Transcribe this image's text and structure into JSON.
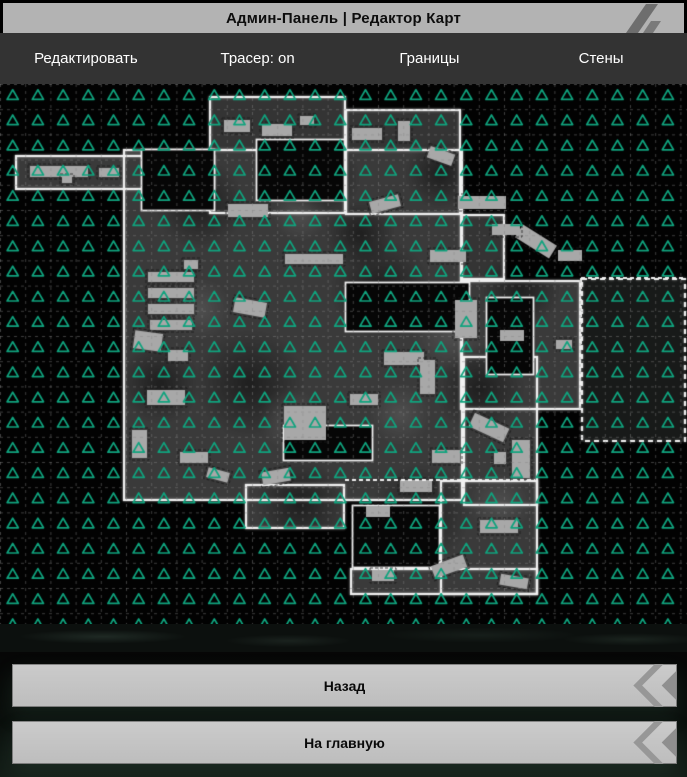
{
  "title_bar": {
    "title": "Админ-Панель | Редактор Карт"
  },
  "toolbar": {
    "items": [
      {
        "label": "Редактировать"
      },
      {
        "label": "Трасер: on"
      },
      {
        "label": "Границы"
      },
      {
        "label": "Стены"
      }
    ]
  },
  "footer": {
    "back_label": "Назад",
    "home_label": "На главную"
  },
  "map": {
    "width": 687,
    "height": 540,
    "colors": {
      "bg": "#020202",
      "floor": "#3a3a3a",
      "floor_dark": "#343434",
      "hole": "#060606",
      "wall": "#efefef",
      "prop": "#a8a8a8",
      "dim": "#181a19"
    },
    "grid": {
      "spacing": 25.2,
      "dash": [
        3,
        4
      ],
      "color": "rgba(135,135,135,0.45)"
    },
    "markers": {
      "cols": 27,
      "rows": 22,
      "start_x": 12.7,
      "start_y": 11,
      "spacing": 25.2,
      "color": "#10a37e",
      "half_width": 5.6,
      "up": 5.2,
      "down": 4.4,
      "line_width": 1.7
    },
    "rooms": [
      {
        "x": 15,
        "y": 71,
        "w": 200,
        "h": 35
      },
      {
        "x": 209,
        "y": 12,
        "w": 137,
        "h": 118,
        "fill": "#343434"
      },
      {
        "x": 345,
        "y": 25,
        "w": 116,
        "h": 106,
        "fill": "#343434"
      },
      {
        "x": 123,
        "y": 65,
        "w": 340,
        "h": 352
      },
      {
        "x": 460,
        "y": 130,
        "w": 45,
        "h": 66,
        "fill": "#343434"
      },
      {
        "x": 460,
        "y": 196,
        "w": 121,
        "h": 130
      },
      {
        "x": 463,
        "y": 272,
        "w": 75,
        "h": 150
      },
      {
        "x": 440,
        "y": 396,
        "w": 98,
        "h": 115
      },
      {
        "x": 350,
        "y": 484,
        "w": 188,
        "h": 27
      },
      {
        "x": 245,
        "y": 400,
        "w": 100,
        "h": 45
      },
      {
        "x": 581,
        "y": 194,
        "w": 105,
        "h": 164,
        "fill": "#181a19",
        "dashed": true
      }
    ],
    "holes": [
      {
        "x": 141,
        "y": 65,
        "w": 74,
        "h": 62
      },
      {
        "x": 256,
        "y": 55,
        "w": 89,
        "h": 62
      },
      {
        "x": 345,
        "y": 198,
        "w": 125,
        "h": 50
      },
      {
        "x": 486,
        "y": 213,
        "w": 48,
        "h": 78
      },
      {
        "x": 283,
        "y": 341,
        "w": 90,
        "h": 36
      },
      {
        "x": 352,
        "y": 421,
        "w": 88,
        "h": 63
      }
    ],
    "dashed_walls": [
      [
        345,
        396,
        535,
        396
      ],
      [
        581,
        194,
        686,
        194
      ],
      [
        581,
        194,
        581,
        260
      ]
    ],
    "props": [
      [
        30,
        82,
        58,
        11,
        0
      ],
      [
        99,
        84,
        20,
        9,
        0
      ],
      [
        62,
        92,
        10,
        7,
        0
      ],
      [
        224,
        36,
        26,
        12,
        0
      ],
      [
        262,
        40,
        30,
        12,
        0
      ],
      [
        300,
        32,
        14,
        9,
        0
      ],
      [
        352,
        44,
        30,
        12,
        0
      ],
      [
        398,
        37,
        12,
        20,
        0
      ],
      [
        428,
        66,
        26,
        12,
        20
      ],
      [
        228,
        120,
        40,
        13,
        0
      ],
      [
        370,
        114,
        30,
        12,
        -15
      ],
      [
        458,
        112,
        48,
        13,
        0
      ],
      [
        516,
        150,
        40,
        15,
        32
      ],
      [
        558,
        166,
        24,
        11,
        0
      ],
      [
        184,
        176,
        14,
        9,
        0
      ],
      [
        285,
        170,
        58,
        10,
        0
      ],
      [
        148,
        188,
        46,
        10,
        0
      ],
      [
        148,
        204,
        46,
        10,
        0
      ],
      [
        148,
        220,
        46,
        10,
        0
      ],
      [
        150,
        236,
        42,
        10,
        0
      ],
      [
        234,
        216,
        32,
        15,
        10
      ],
      [
        430,
        166,
        36,
        12,
        0
      ],
      [
        492,
        140,
        28,
        11,
        0
      ],
      [
        455,
        216,
        22,
        38,
        0
      ],
      [
        384,
        268,
        40,
        13,
        0
      ],
      [
        420,
        276,
        15,
        34,
        0
      ],
      [
        134,
        248,
        28,
        18,
        8
      ],
      [
        168,
        266,
        20,
        11,
        0
      ],
      [
        147,
        306,
        38,
        15,
        0
      ],
      [
        132,
        346,
        15,
        28,
        0
      ],
      [
        180,
        368,
        28,
        11,
        0
      ],
      [
        207,
        386,
        22,
        10,
        15
      ],
      [
        284,
        322,
        42,
        34,
        0
      ],
      [
        350,
        310,
        28,
        11,
        0
      ],
      [
        262,
        386,
        28,
        13,
        -10
      ],
      [
        500,
        246,
        24,
        11,
        0
      ],
      [
        556,
        256,
        16,
        9,
        0
      ],
      [
        470,
        336,
        38,
        15,
        25
      ],
      [
        512,
        356,
        18,
        38,
        0
      ],
      [
        432,
        366,
        28,
        13,
        0
      ],
      [
        400,
        396,
        32,
        12,
        0
      ],
      [
        366,
        422,
        24,
        11,
        0
      ],
      [
        480,
        436,
        38,
        13,
        0
      ],
      [
        494,
        368,
        12,
        12,
        0
      ],
      [
        432,
        476,
        34,
        13,
        -20
      ],
      [
        372,
        486,
        22,
        11,
        0
      ],
      [
        500,
        492,
        28,
        11,
        10
      ]
    ],
    "shades": [
      [
        200,
        120,
        45
      ],
      [
        320,
        95,
        40
      ],
      [
        380,
        205,
        50
      ],
      [
        250,
        300,
        55
      ],
      [
        480,
        305,
        45
      ],
      [
        420,
        430,
        50
      ],
      [
        160,
        300,
        40
      ],
      [
        520,
        205,
        40
      ],
      [
        300,
        420,
        45
      ],
      [
        360,
        150,
        35
      ],
      [
        440,
        90,
        35
      ],
      [
        180,
        90,
        30
      ]
    ],
    "lights": [
      [
        290,
        335,
        32
      ],
      [
        450,
        250,
        38
      ],
      [
        200,
        225,
        32
      ],
      [
        400,
        330,
        32
      ],
      [
        500,
        420,
        32
      ],
      [
        300,
        130,
        28
      ]
    ]
  }
}
